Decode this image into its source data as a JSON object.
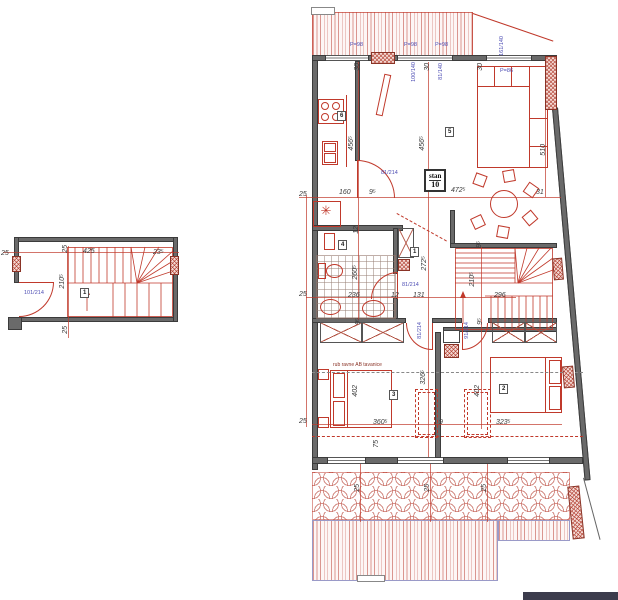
{
  "palette": {
    "accent_red": "#c0392b",
    "wall_gray": "#6a6a6a",
    "blue_label": "#4e4eb4",
    "hatch_border_blue": "#9a9ac8"
  },
  "unit_box": {
    "line1": "stan",
    "line2": "10"
  },
  "notes": {
    "slab_edge": "rub ravne AB tavanice"
  },
  "overlays": [
    {
      "kind": "dim",
      "t": "25",
      "x": 299,
      "y": 191
    },
    {
      "kind": "dim",
      "t": "160",
      "x": 339,
      "y": 189
    },
    {
      "kind": "dim",
      "t": "9⁵",
      "x": 369,
      "y": 189
    },
    {
      "kind": "dim",
      "t": "472⁵",
      "x": 451,
      "y": 187
    },
    {
      "kind": "dim",
      "t": "31",
      "x": 536,
      "y": 189
    },
    {
      "kind": "dim",
      "t": "456⁵",
      "x": 348,
      "y": 136,
      "r": 1
    },
    {
      "kind": "dim",
      "t": "456⁵",
      "x": 419,
      "y": 136,
      "r": 1
    },
    {
      "kind": "dim",
      "t": "510",
      "x": 540,
      "y": 144,
      "r": 1
    },
    {
      "kind": "dim",
      "t": "30",
      "x": 354,
      "y": 63,
      "r": 1
    },
    {
      "kind": "dim",
      "t": "30",
      "x": 424,
      "y": 63,
      "r": 1
    },
    {
      "kind": "dim",
      "t": "30",
      "x": 477,
      "y": 63,
      "r": 1
    },
    {
      "kind": "dim",
      "t": "12",
      "x": 353,
      "y": 226,
      "r": 1
    },
    {
      "kind": "dim",
      "t": "260⁵",
      "x": 352,
      "y": 265,
      "r": 1
    },
    {
      "kind": "dim",
      "t": "236",
      "x": 348,
      "y": 292
    },
    {
      "kind": "dim",
      "t": "12",
      "x": 391,
      "y": 292
    },
    {
      "kind": "dim",
      "t": "131",
      "x": 413,
      "y": 292
    },
    {
      "kind": "dim",
      "t": "296",
      "x": 494,
      "y": 292
    },
    {
      "kind": "dim",
      "t": "272⁵",
      "x": 421,
      "y": 256,
      "r": 1
    },
    {
      "kind": "dim",
      "t": "210⁵",
      "x": 469,
      "y": 272,
      "r": 1
    },
    {
      "kind": "dim",
      "t": "9⁵",
      "x": 476,
      "y": 241,
      "r": 1
    },
    {
      "kind": "dim",
      "t": "9⁵",
      "x": 477,
      "y": 318,
      "r": 1
    },
    {
      "kind": "dim",
      "t": "9⁵",
      "x": 355,
      "y": 318,
      "r": 1
    },
    {
      "kind": "dim",
      "t": "25",
      "x": 299,
      "y": 291
    },
    {
      "kind": "dim",
      "t": "25",
      "x": 299,
      "y": 418
    },
    {
      "kind": "dim",
      "t": "402",
      "x": 352,
      "y": 385,
      "r": 1
    },
    {
      "kind": "dim",
      "t": "402",
      "x": 474,
      "y": 385,
      "r": 1
    },
    {
      "kind": "dim",
      "t": "360⁵",
      "x": 373,
      "y": 419
    },
    {
      "kind": "dim",
      "t": "323⁵",
      "x": 496,
      "y": 419
    },
    {
      "kind": "dim",
      "t": "326⁵",
      "x": 420,
      "y": 370,
      "r": 1
    },
    {
      "kind": "dim",
      "t": "9",
      "x": 439,
      "y": 419
    },
    {
      "kind": "dim",
      "t": "75",
      "x": 373,
      "y": 440,
      "r": 1
    },
    {
      "kind": "dim",
      "t": "25",
      "x": 354,
      "y": 484,
      "r": 1
    },
    {
      "kind": "dim",
      "t": "25",
      "x": 424,
      "y": 484,
      "r": 1
    },
    {
      "kind": "dim",
      "t": "25",
      "x": 481,
      "y": 484,
      "r": 1
    },
    {
      "kind": "dim",
      "t": "25",
      "x": 1,
      "y": 250
    },
    {
      "kind": "dim",
      "t": "425",
      "x": 83,
      "y": 248
    },
    {
      "kind": "dim",
      "t": "23⁵",
      "x": 153,
      "y": 249
    },
    {
      "kind": "dim",
      "t": "25",
      "x": 62,
      "y": 245,
      "r": 1
    },
    {
      "kind": "dim",
      "t": "210⁵",
      "x": 59,
      "y": 274,
      "r": 1
    },
    {
      "kind": "dim",
      "t": "25",
      "x": 62,
      "y": 326,
      "r": 1
    },
    {
      "kind": "blue",
      "t": "P=98",
      "x": 350,
      "y": 42
    },
    {
      "kind": "blue",
      "t": "P=98",
      "x": 404,
      "y": 42
    },
    {
      "kind": "blue",
      "t": "P=98",
      "x": 435,
      "y": 42
    },
    {
      "kind": "blue",
      "t": "100/140",
      "x": 411,
      "y": 62,
      "r": 1
    },
    {
      "kind": "blue",
      "t": "81/140",
      "x": 438,
      "y": 63,
      "r": 1
    },
    {
      "kind": "blue",
      "t": "161/140",
      "x": 499,
      "y": 36,
      "r": 1
    },
    {
      "kind": "blue",
      "t": "P=86",
      "x": 500,
      "y": 68
    },
    {
      "kind": "blue",
      "t": "81/214",
      "x": 381,
      "y": 170
    },
    {
      "kind": "blue",
      "t": "81/214",
      "x": 402,
      "y": 282
    },
    {
      "kind": "blue",
      "t": "81/214",
      "x": 417,
      "y": 322,
      "r": 1
    },
    {
      "kind": "blue",
      "t": "91/214",
      "x": 464,
      "y": 322,
      "r": 1
    },
    {
      "kind": "blue",
      "t": "101/214",
      "x": 24,
      "y": 290
    },
    {
      "kind": "room",
      "t": "6",
      "x": 337,
      "y": 111
    },
    {
      "kind": "room",
      "t": "5",
      "x": 445,
      "y": 127
    },
    {
      "kind": "room",
      "t": "4",
      "x": 338,
      "y": 240
    },
    {
      "kind": "room",
      "t": "1",
      "x": 410,
      "y": 247
    },
    {
      "kind": "room",
      "t": "3",
      "x": 389,
      "y": 390
    },
    {
      "kind": "room",
      "t": "2",
      "x": 499,
      "y": 384
    },
    {
      "kind": "room",
      "t": "1",
      "x": 80,
      "y": 288
    }
  ]
}
